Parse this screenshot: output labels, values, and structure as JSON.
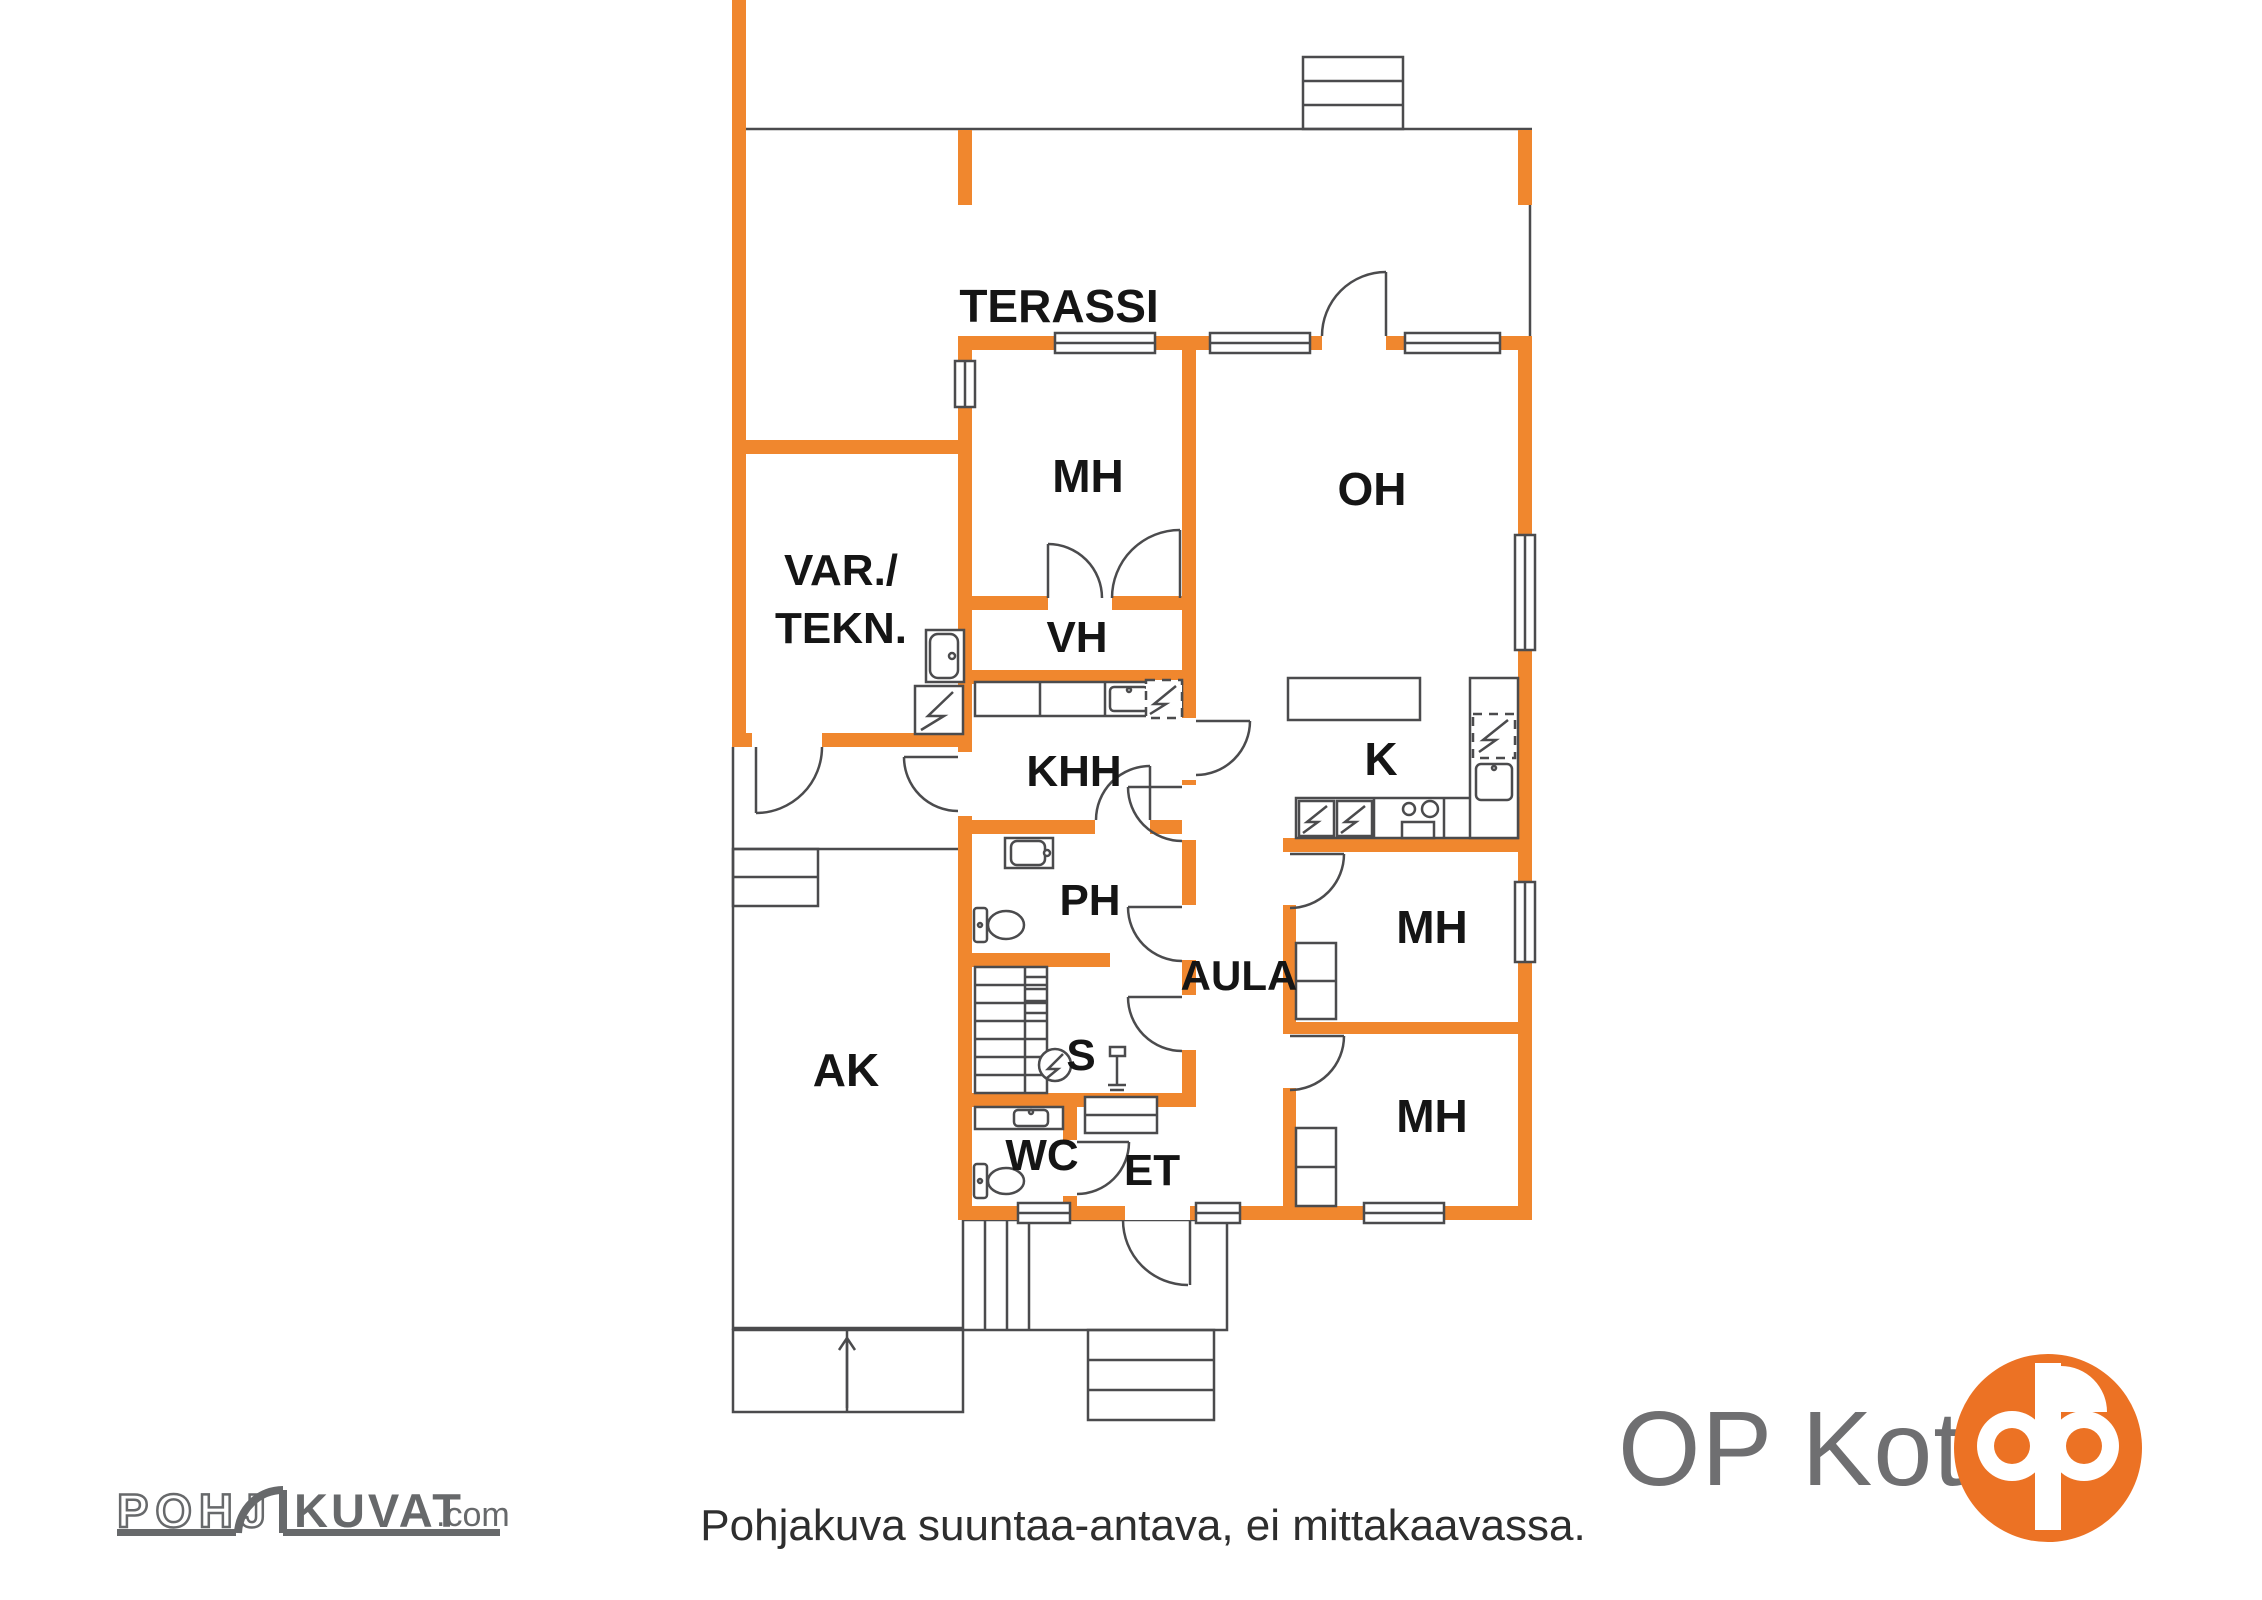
{
  "plan": {
    "colors": {
      "wall": "#F0872E",
      "line": "#4B4B4D",
      "label": "#151515"
    },
    "rooms": [
      {
        "id": "terassi",
        "label": "TERASSI"
      },
      {
        "id": "mh-top",
        "label": "MH"
      },
      {
        "id": "oh",
        "label": "OH"
      },
      {
        "id": "var-tekn",
        "label": "VAR./",
        "label2": "TEKN."
      },
      {
        "id": "vh",
        "label": "VH"
      },
      {
        "id": "khh",
        "label": "KHH"
      },
      {
        "id": "k",
        "label": "K"
      },
      {
        "id": "ph",
        "label": "PH"
      },
      {
        "id": "aula",
        "label": "AULA"
      },
      {
        "id": "s",
        "label": "S"
      },
      {
        "id": "ak",
        "label": "AK"
      },
      {
        "id": "wc",
        "label": "WC"
      },
      {
        "id": "et",
        "label": "ET"
      },
      {
        "id": "mh-mid",
        "label": "MH"
      },
      {
        "id": "mh-bot",
        "label": "MH"
      }
    ],
    "disclaimer": "Pohjakuva suuntaa-antava, ei mittakaavassa."
  },
  "branding": {
    "pohjakuvat": {
      "outline_word": "POHJ",
      "solid_word": "KUVAT",
      "tld": ".com",
      "color": "#67696B"
    },
    "opkoti": {
      "wordmark": "OP Koti",
      "text_color": "#6F6F71",
      "symbol_color": "#EC7224"
    }
  }
}
